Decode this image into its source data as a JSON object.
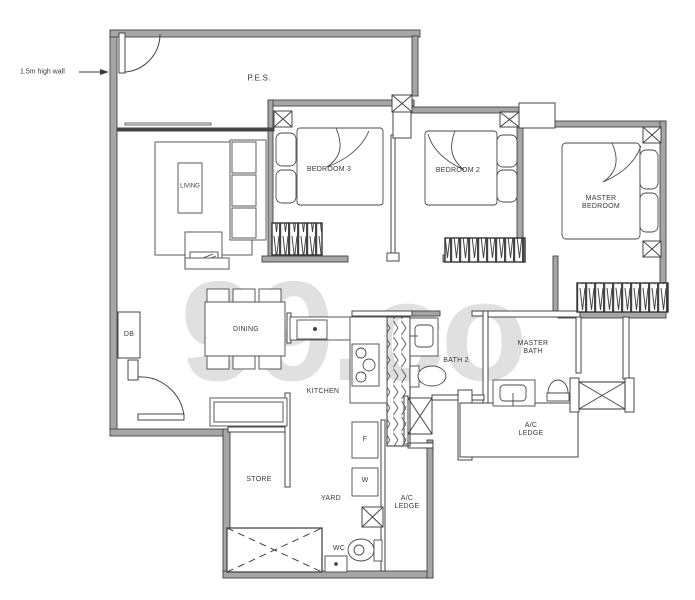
{
  "watermark": "99.co",
  "annotation": {
    "high_wall": "1.5m high wall"
  },
  "rooms": {
    "pes": "P.E.S.",
    "living": "LIVING",
    "bedroom3": "BEDROOM 3",
    "bedroom2": "BEDROOM 2",
    "master_bedroom": "MASTER BEDROOM",
    "dining": "DINING",
    "kitchen": "KITCHEN",
    "bath2": "BATH 2",
    "master_bath": "MASTER BATH",
    "ac_ledge_upper": "A/C LEDGE",
    "ac_ledge_lower": "A/C LEDGE",
    "store": "STORE",
    "yard": "YARD",
    "wc": "WC",
    "db": "DB",
    "fridge": "F",
    "washer": "W"
  },
  "colors": {
    "wall_fill": "#a6a6a6",
    "line": "#444444",
    "text": "#3a3a3a",
    "watermark": "#cbcbcb",
    "background": "#ffffff"
  }
}
